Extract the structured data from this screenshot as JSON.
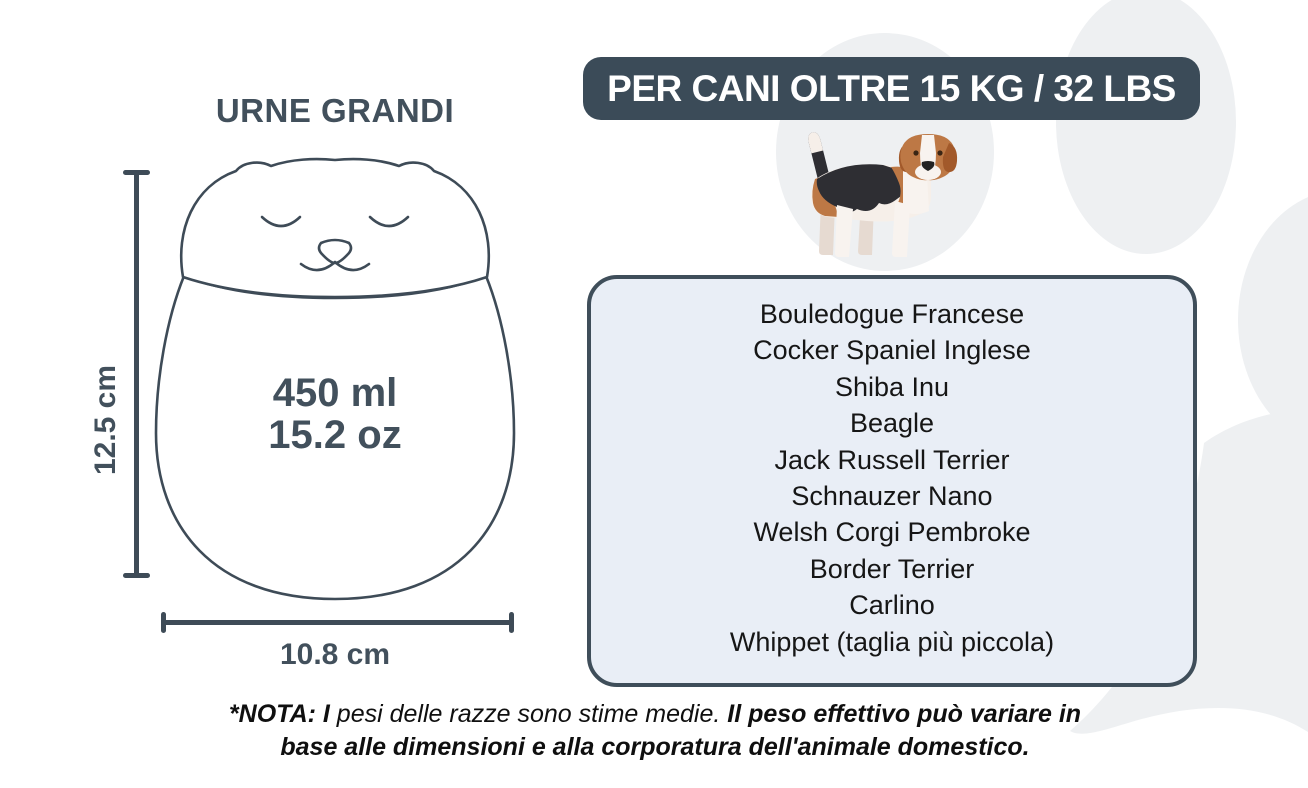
{
  "left_panel": {
    "title": "URNE GRANDI",
    "urn": {
      "height_label": "12.5 cm",
      "width_label": "10.8 cm",
      "volume_ml": "450 ml",
      "volume_oz": "15.2 oz"
    }
  },
  "right_panel": {
    "header": "PER CANI OLTRE 15 KG / 32 LBS",
    "breeds": [
      "Bouledogue Francese",
      "Cocker Spaniel Inglese",
      "Shiba Inu",
      "Beagle",
      "Jack Russell Terrier",
      "Schnauzer Nano",
      "Welsh Corgi Pembroke",
      "Border Terrier",
      "Carlino",
      "Whippet (taglia più piccola)"
    ]
  },
  "note": {
    "bold_intro": "*NOTA: I ",
    "regular": "pesi delle razze sono stime medie. ",
    "bold_rest": "Il peso effettivo può variare in base alle dimensioni e alla corporatura dell'animale domestico."
  },
  "icons": {
    "urn": "cat-shaped-urn-illustration",
    "dog": "beagle-dog-illustration",
    "background": "paw-print-decoration"
  },
  "colors": {
    "slate": "#3b4b58",
    "text_slate": "#42505c",
    "list_background": "#e9eef6",
    "list_text": "#161616",
    "decoration_gray": "#eef0f2",
    "beagle_tan": "#bd7845",
    "beagle_black": "#2e2e33",
    "beagle_cream": "#f6efe9"
  }
}
